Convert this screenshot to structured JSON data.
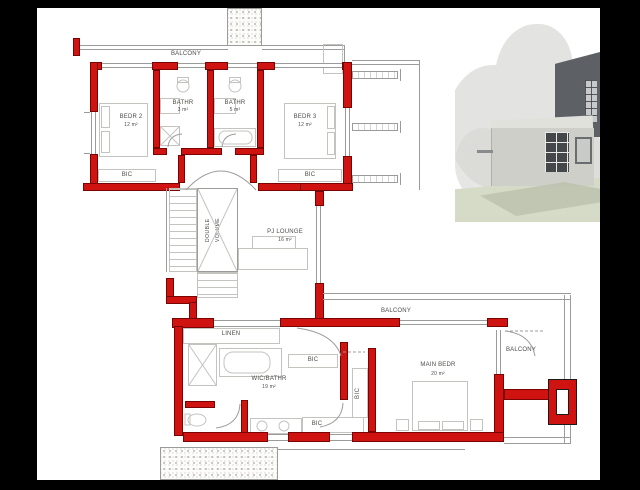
{
  "plan": {
    "labels": {
      "balcony": "BALCONY",
      "linen": "LINEN",
      "bic": "BIC",
      "double_volume_line1": "DOUBLE",
      "double_volume_line2": "VOLUME"
    },
    "rooms": [
      {
        "name": "BEDR 2",
        "area": "12 m²"
      },
      {
        "name": "BATHR",
        "area": "3 m²"
      },
      {
        "name": "BATHR",
        "area": "5 m²"
      },
      {
        "name": "BEDR 3",
        "area": "12 m²"
      },
      {
        "name": "PJ LOUNGE",
        "area": "16 m²"
      },
      {
        "name": "WIC/BATHR",
        "area": "19 m²"
      },
      {
        "name": "MAIN BEDR",
        "area": "20 m²"
      }
    ]
  },
  "colors": {
    "frame": "#000000",
    "paper": "#ffffff",
    "wall": "#ce1310",
    "wall-dark": "#7a0402",
    "line": "#9b9b99",
    "furn": "#c3c3c0",
    "ink": "#4c4c4a",
    "concrete-dot": "#a09a90",
    "render-dark": "#5d6165",
    "render-light": "#cfcfc9",
    "render-top": "#e1e1db",
    "render-tree": "#e3e3e1",
    "render-tree2": "#d5d5d2",
    "render-ground": "#d6dbc8",
    "render-shadow": "#bcc2ae"
  }
}
